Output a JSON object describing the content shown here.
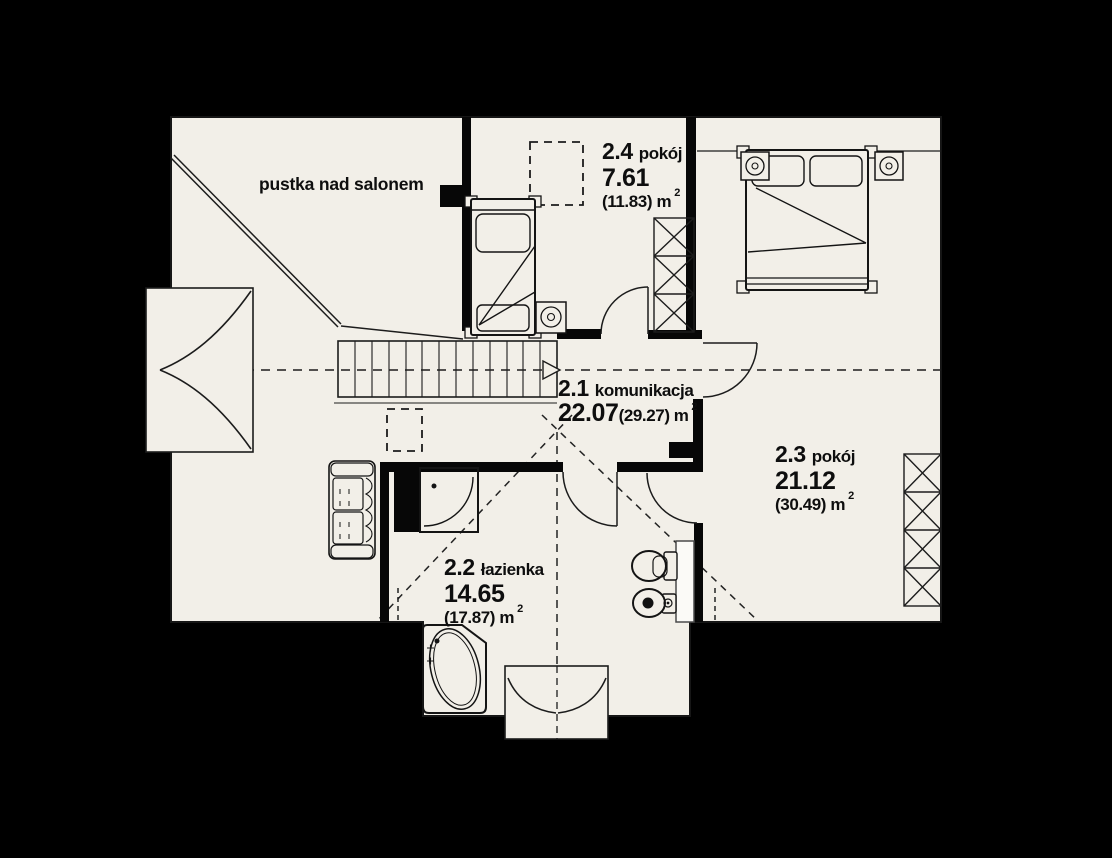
{
  "plan": {
    "background_color": "#000000",
    "floor_color": "#f2efe8",
    "wall_color": "#070707",
    "line_color": "#1c1c1c",
    "void_label": "pustka nad salonem",
    "rooms": [
      {
        "number": "2.1",
        "name": "komunikacja",
        "area": "22.07",
        "area_total": "(29.27)",
        "unit": "m",
        "sup": "2"
      },
      {
        "number": "2.2",
        "name": "łazienka",
        "area": "14.65",
        "area_total": "(17.87)",
        "unit": "m",
        "sup": "2"
      },
      {
        "number": "2.3",
        "name": "pokój",
        "area": "21.12",
        "area_total": "(30.49)",
        "unit": "m",
        "sup": "2"
      },
      {
        "number": "2.4",
        "name": "pokój",
        "area": "7.61",
        "area_total": "(11.83)",
        "unit": "m",
        "sup": "2"
      }
    ]
  }
}
